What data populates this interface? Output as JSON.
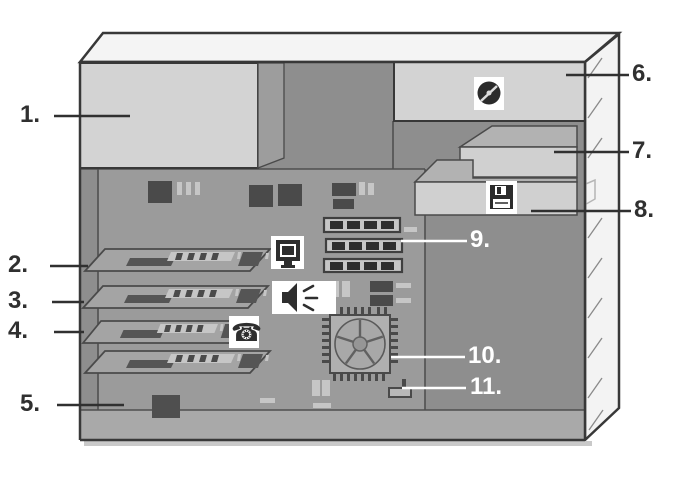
{
  "diagram": {
    "background": "#ffffff",
    "callouts": [
      {
        "text": "1.",
        "color": "#303030"
      },
      {
        "text": "2.",
        "color": "#303030"
      },
      {
        "text": "3.",
        "color": "#303030"
      },
      {
        "text": "4.",
        "color": "#303030"
      },
      {
        "text": "5.",
        "color": "#303030"
      },
      {
        "text": "6.",
        "color": "#303030"
      },
      {
        "text": "7.",
        "color": "#303030"
      },
      {
        "text": "8.",
        "color": "#303030"
      },
      {
        "text": "9.",
        "color": "#ffffff"
      },
      {
        "text": "10.",
        "color": "#ffffff"
      },
      {
        "text": "11.",
        "color": "#ffffff"
      }
    ],
    "icons": {
      "monitor": "monitor-icon",
      "speaker": "speaker-icon",
      "phone_glyph": "☎",
      "cd": "cd-disc-icon",
      "floppy": "floppy-disk-icon",
      "cpu_fan": "cpu-fan-icon"
    },
    "colors": {
      "case_outline": "#383838",
      "case_top": "#f4f4f4",
      "front_panel": "#f3f3f3",
      "bay_device_light": "#d3d3d3",
      "bay_device_top": "#b2b2b2",
      "interior": "#8e8e8e",
      "motherboard": "#9b9b9b",
      "card_face": "#a4a4a4",
      "chip_dark": "#4a4a4a",
      "highlight_light": "#c6c6c6",
      "bottom_lip": "#a9a9a9",
      "label_dark": "#303030",
      "label_light": "#ffffff"
    }
  }
}
